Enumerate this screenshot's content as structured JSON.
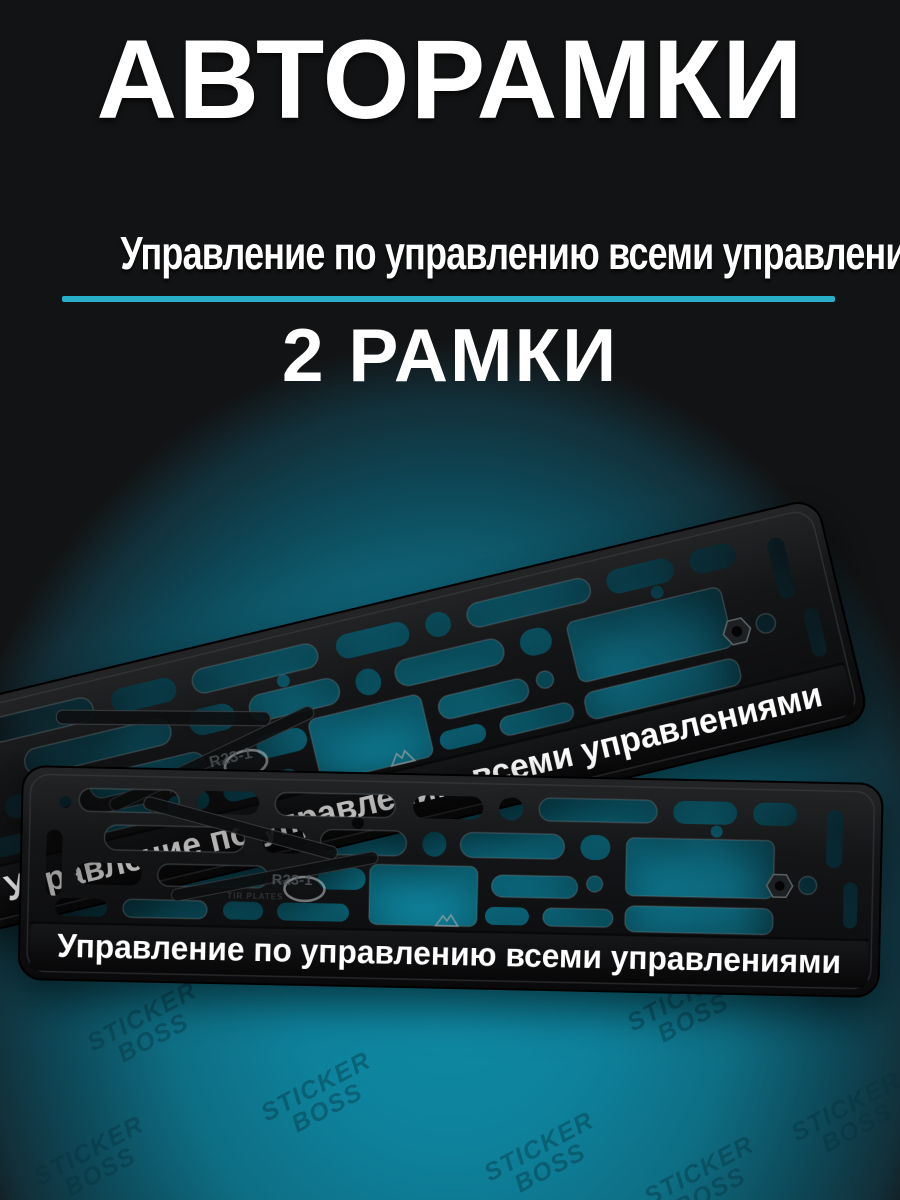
{
  "header": {
    "title": "АВТОРАМКИ",
    "subtitle": "Управление по управлению всеми управлениями",
    "count_label": "2 РАМКИ",
    "divider_color": "#2aadc9"
  },
  "product": {
    "frame_text": "Управление по управлению всеми управлениями",
    "mold_code": "R23-1",
    "mold_note": "TIR PLATES",
    "brand": "ARS",
    "frame_color": "#17181a",
    "strip_color": "#0c0d0e",
    "text_color": "#ffffff",
    "quantity": "2"
  },
  "background": {
    "base": "#121314",
    "glow": "#0f8ba6"
  },
  "watermark": {
    "line1": "STICKER",
    "line2": "BOSS"
  }
}
